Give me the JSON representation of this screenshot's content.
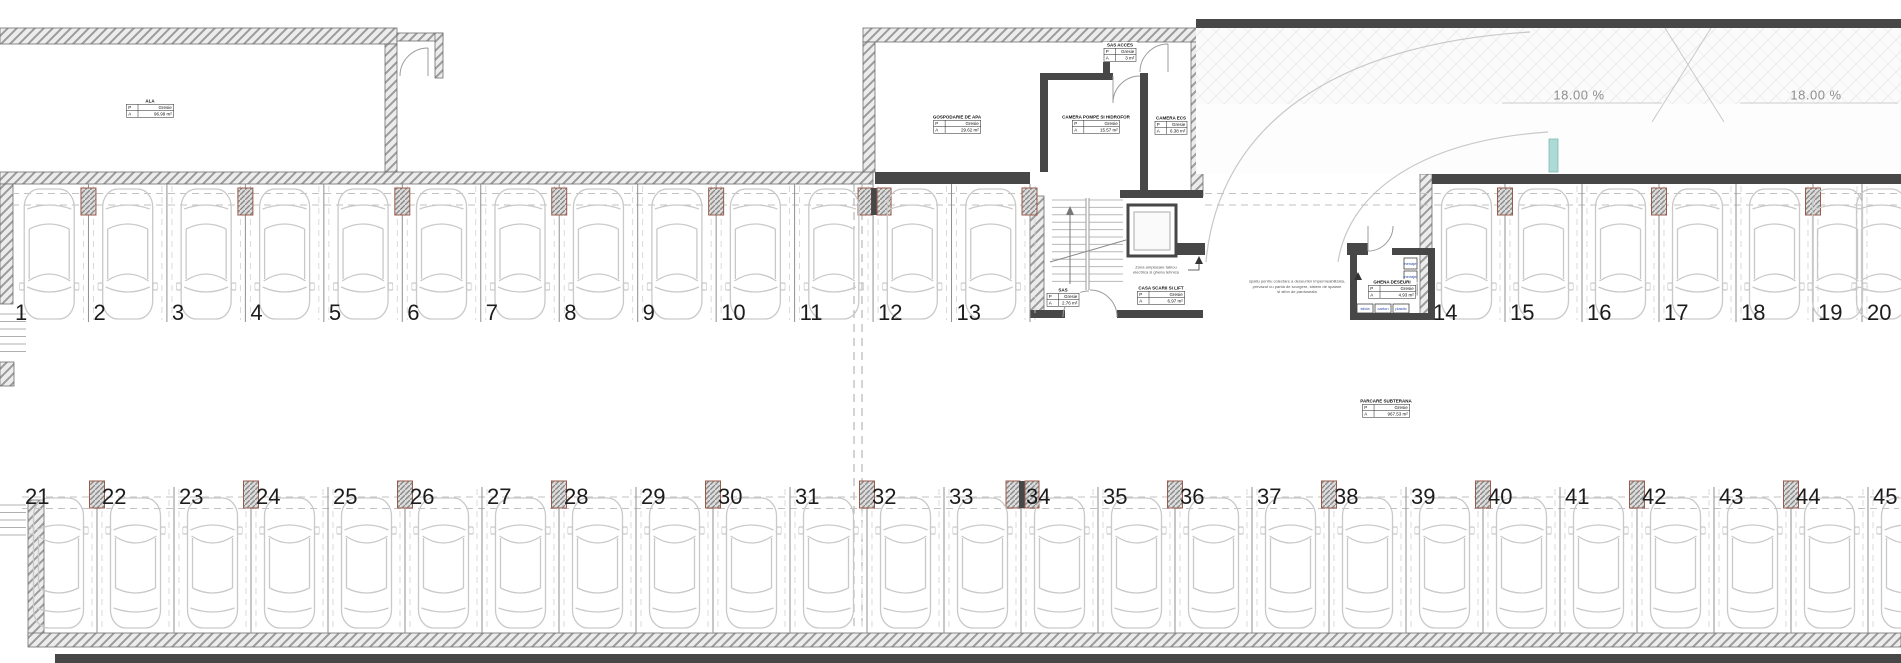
{
  "drawing": {
    "kind": "underground parking floor plan",
    "floor_key": "P",
    "area_key": "A"
  },
  "rooms": [
    {
      "id": "ala",
      "name": "ALA",
      "floor": "Gresie",
      "area": "96.99 m²"
    },
    {
      "id": "gospodarie-apa",
      "name": "GOSPODARIE DE APA",
      "floor": "Gresie",
      "area": "29.62 m²"
    },
    {
      "id": "camera-pompe",
      "name": "CAMERA POMPE SI HIDROFOR",
      "floor": "Gresie",
      "area": "15.57 m²"
    },
    {
      "id": "sas-acces",
      "name": "SAS ACCES",
      "floor": "Gresie",
      "area": "3 m²"
    },
    {
      "id": "camera-ecs",
      "name": "CAMERA ECS",
      "floor": "Gresie",
      "area": "6.38 m²"
    },
    {
      "id": "sas",
      "name": "SAS",
      "floor": "Gresie",
      "area": "2.76 m²"
    },
    {
      "id": "casa-scarii",
      "name": "CASA SCARII SI LIFT",
      "floor": "Gresie",
      "area": "6.97 m²"
    },
    {
      "id": "ghena",
      "name": "GHENA DESEURI",
      "floor": "Gresie",
      "area": "4.93 m²"
    },
    {
      "id": "parcare",
      "name": "PARCARE SUBTERANA",
      "floor": "Gresie",
      "area": "967.53 m²"
    }
  ],
  "stalls": {
    "top_left": [
      "1",
      "2",
      "3",
      "4",
      "5",
      "6",
      "7",
      "8",
      "9",
      "10",
      "11",
      "12",
      "13"
    ],
    "top_right": [
      "14",
      "15",
      "16",
      "17",
      "18",
      "19",
      "20"
    ],
    "bottom": [
      "21",
      "22",
      "23",
      "24",
      "25",
      "26",
      "27",
      "28",
      "29",
      "30",
      "31",
      "32",
      "33",
      "34",
      "35",
      "36",
      "37",
      "38",
      "39",
      "40",
      "41",
      "42",
      "43",
      "44",
      "45"
    ]
  },
  "annotations": [
    {
      "id": "zona-tablou",
      "lines": [
        "Zona amplasare tablou",
        "electrica si ghena tehnica"
      ]
    },
    {
      "id": "ghena-note",
      "lines": [
        "spatiu pentru colectare a deseurilor impermeabilizata,",
        "prevazut cu panta de scurgere, sistem de spalare",
        "si sifon de pardoseala"
      ]
    }
  ],
  "ramp": {
    "slope_labels": [
      "18.00 %",
      "18.00 %"
    ]
  },
  "bins": [
    "sticla",
    "carton",
    "plastic",
    "menajer",
    "menajer",
    "menajer"
  ],
  "colors": {
    "wall_fill": "#ececec",
    "wall_hatch": "#9b9b9b",
    "wall_edge": "#6f6f6f",
    "dark_wall": "#474747",
    "column_accent": "#9a5b4b",
    "car_line": "#c9c9c9",
    "dash_line": "#c2c2c2",
    "stall_line": "#8f8f8f",
    "teal_marker": "#aedad6",
    "slope_text": "#8e8e8e",
    "bin_text": "#2a49a8"
  }
}
